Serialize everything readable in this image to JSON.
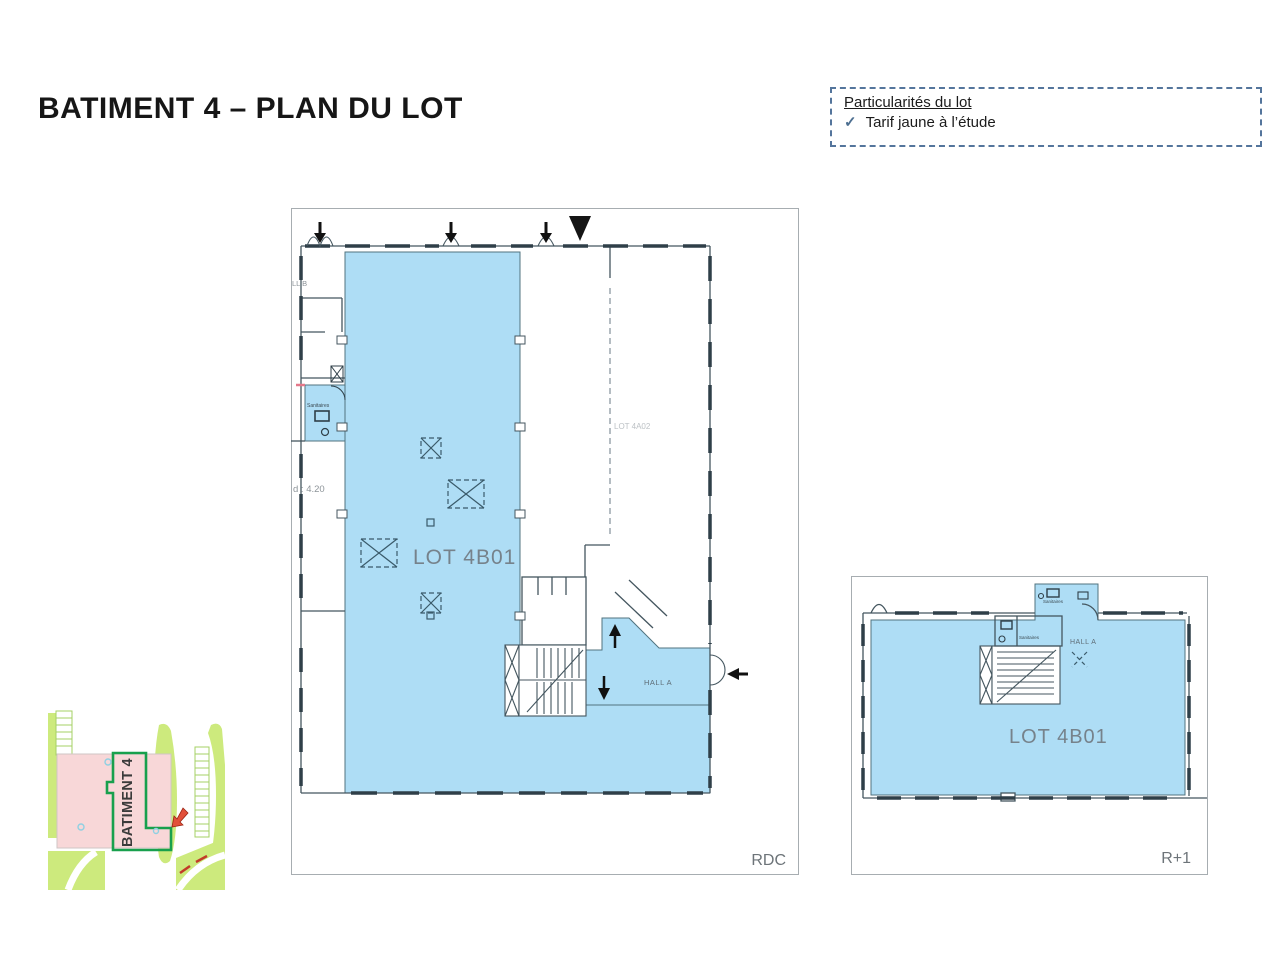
{
  "page": {
    "title": "BATIMENT 4 – PLAN DU LOT"
  },
  "particularites_box": {
    "heading": "Particularités du lot",
    "check_icon": "✓",
    "item": "Tarif jaune à l’étude"
  },
  "plan_rdc": {
    "floor_label": "RDC",
    "lot_label": "LOT 4B01",
    "adjacent_lot_label": "LOT 4A02",
    "hall_a_label": "HALL A",
    "hall_b_partial_label": "LL B",
    "sanitaires_label": "Sanitaires",
    "height_label": "d : 4.20"
  },
  "plan_r1": {
    "floor_label": "R+1",
    "lot_label": "LOT 4B01",
    "hall_a_label": "HALL A",
    "sanitaires_top_label": "Sanitaires",
    "sanitaires_inner_label": "Sanitaires"
  },
  "site_map": {
    "building_label": "BATIMENT 4"
  },
  "colors": {
    "lot_fill": "#aeddf5",
    "wall": "#44565f",
    "box_border": "#54759c",
    "check": "#4d6f91",
    "site_green": "#cdea7d",
    "site_building_fill": "#f8d7d8",
    "site_outline": "#18a04d",
    "site_arrow": "#e2503a"
  }
}
